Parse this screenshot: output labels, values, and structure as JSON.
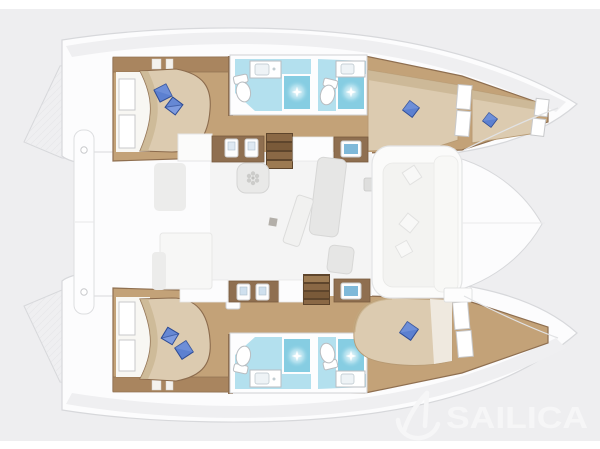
{
  "watermark": {
    "brand": "SAILICA",
    "logo_icon": "sailboat-icon"
  },
  "diagram": {
    "type": "catamaran-deck-plan-top-view",
    "orientation": "bow-right",
    "rooms": {
      "double_cabins": 2,
      "single_bow_berths": 3,
      "bathrooms": 4,
      "showers": 4,
      "toilets": 4,
      "saloon": 1,
      "stairways": 2,
      "cockpit_lounges": 2
    },
    "pillows": {
      "blue": 7,
      "white": 3
    }
  },
  "palette": {
    "background": "#eeeef0",
    "page_strip": "#ffffff",
    "hull_white": "#fcfcfd",
    "outline": "#d7d8db",
    "deck_shade": "#efeff1",
    "wood_floor": "#c3a278",
    "wood_dark": "#8f6f50",
    "wood_trim": "#a9855f",
    "bed_beige": "#dccbb0",
    "bed_shade": "#cab694",
    "bed_sheet": "#f8f7f3",
    "pillow_blue": "#5c80d0",
    "pillow_blue_dark": "#2e4c95",
    "pillow_blue_light": "#7e9bdf",
    "bath_floor": "#b3e0ee",
    "shower_blue": "#86cde2",
    "fixture_stroke": "#b9bdc1",
    "sink_blue": "#7fb9d9",
    "sofa_gray": "#e6e6e5",
    "watermark_color": "#f6f6f7"
  }
}
